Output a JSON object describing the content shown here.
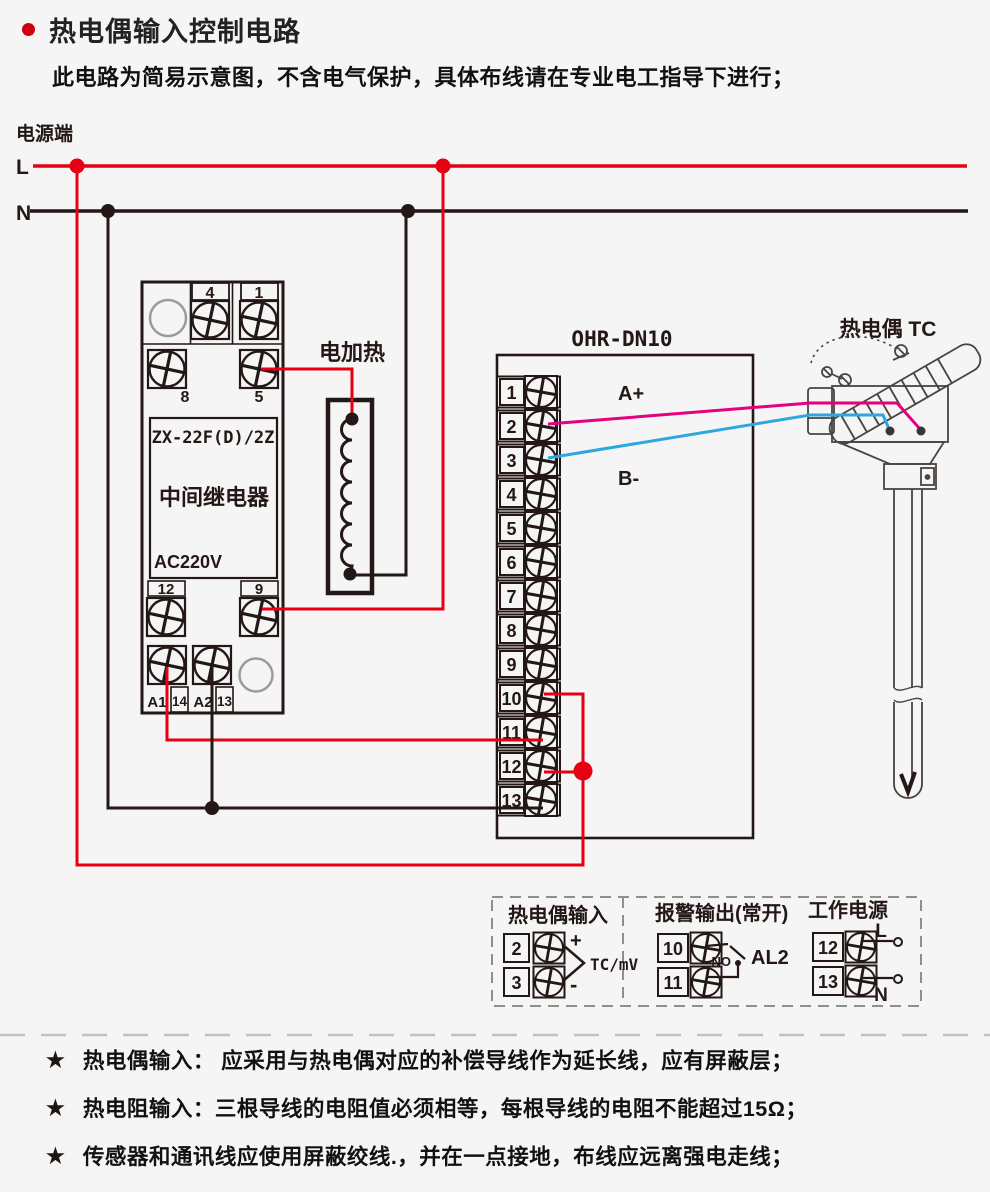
{
  "page": {
    "title": "热电偶输入控制电路",
    "subtitle": "此电路为简易示意图，不含电气保护，具体布线请在专业电工指导下进行；"
  },
  "power": {
    "label": "电源端",
    "live": "L",
    "neutral": "N"
  },
  "relay": {
    "model": "ZX-22F(D)/2Z",
    "name": "中间继电器",
    "voltage": "AC220V",
    "terminals": [
      "4",
      "1",
      "8",
      "5",
      "12",
      "9",
      "A1",
      "14",
      "A2",
      "13"
    ]
  },
  "heater": {
    "label": "电加热"
  },
  "controller": {
    "model": "OHR-DN10",
    "terminals": [
      "1",
      "2",
      "3",
      "4",
      "5",
      "6",
      "7",
      "8",
      "9",
      "10",
      "11",
      "12",
      "13"
    ],
    "wire_a": "A+",
    "wire_b": "B-"
  },
  "thermocouple": {
    "label": "热电偶 TC"
  },
  "legend": {
    "tc_input": {
      "title": "热电偶输入",
      "t2": "2",
      "t3": "3",
      "plus": "+",
      "minus": "-",
      "signal": "TC/mV"
    },
    "alarm": {
      "title": "报警输出(常开)",
      "t10": "10",
      "t11": "11",
      "no": "NO",
      "name": "AL2"
    },
    "supply": {
      "title": "工作电源",
      "t12": "12",
      "t13": "13",
      "l": "L",
      "n": "N"
    }
  },
  "notes": {
    "star": "★",
    "items": [
      "热电偶输入： 应采用与热电偶对应的补偿导线作为延长线，应有屏蔽层；",
      "热电阻输入：三根导线的电阻值必须相等，每根导线的电阻不能超过15Ω；",
      "传感器和通讯线应使用屏蔽绞线.，并在一点接地，布线应远离强电走线；"
    ]
  },
  "colors": {
    "red": "#e60012",
    "pink": "#e4007f",
    "blue": "#2ea7e0",
    "line": "#231815",
    "gray": "#9b9b9b"
  }
}
